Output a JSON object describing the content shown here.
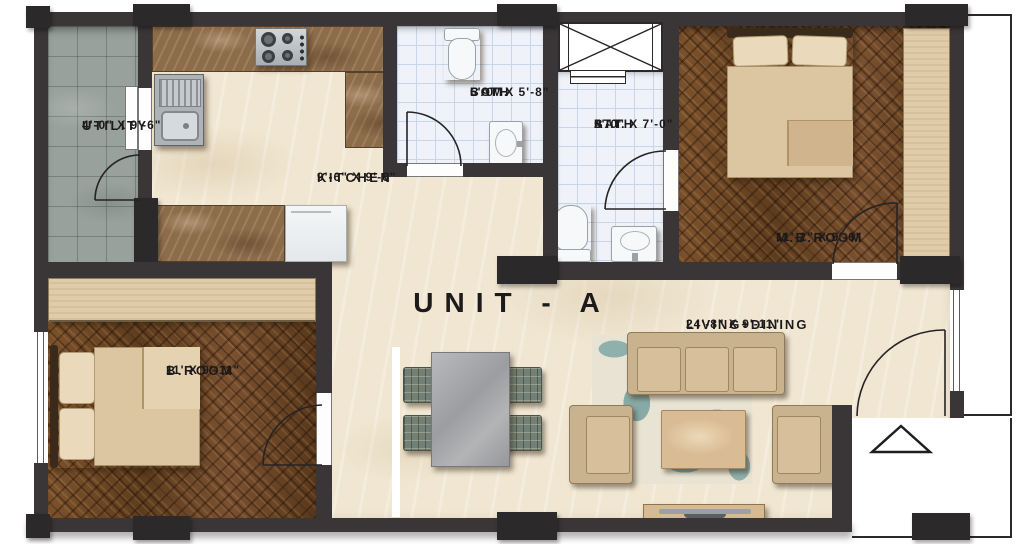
{
  "title": "UNIT - A",
  "rooms": {
    "utility": {
      "name": "UTILITY",
      "dims": "4'-0\" X 9'-6\""
    },
    "kitchen": {
      "name": "KITCHEN",
      "dims": "9'-6\" X 9'-6\""
    },
    "com_bath": {
      "line1": "COM.",
      "line2": "BATH",
      "dims": "5'-0\" X 5'-8\""
    },
    "att_bath": {
      "line1": "ATT.",
      "line2": "BATH",
      "dims": "5'-0\" X 7'-0\""
    },
    "mb_room": {
      "name": "M.B.ROOM",
      "dims": "11'-2\" X 9'-6\""
    },
    "b_room": {
      "name": "B.ROOM",
      "dims": "11' X 9'-11\""
    },
    "living_dining": {
      "name": "LIVING+DINING",
      "dims": "24'-8\" X 9'-11\""
    }
  },
  "objects": [
    "gas-stove",
    "kitchen-sink",
    "refrigerator",
    "toilet",
    "washbasin",
    "duct-shaft",
    "double-bed",
    "wardrobe",
    "dining-table",
    "dining-chair",
    "sofa-3-seater",
    "armchair",
    "coffee-table",
    "tv-unit",
    "rug",
    "entry-arrow",
    "door-swing",
    "window"
  ],
  "colors": {
    "wall": "#3a3637",
    "pillar": "#2c292b",
    "floor_marble": "#f0e6d1",
    "utility_floor": "#98a19b",
    "counter_marble": "#8d6c4a",
    "bath_tile": "#eff3f9",
    "bath_grid": "#c7d6ea",
    "wood": "#6e4726",
    "furniture_beige": "#d6bf9a",
    "chair_green": "#738076",
    "table_gray": "#aaabad",
    "rug_teal": "#8fb0ab",
    "text": "#1d1a1b"
  }
}
